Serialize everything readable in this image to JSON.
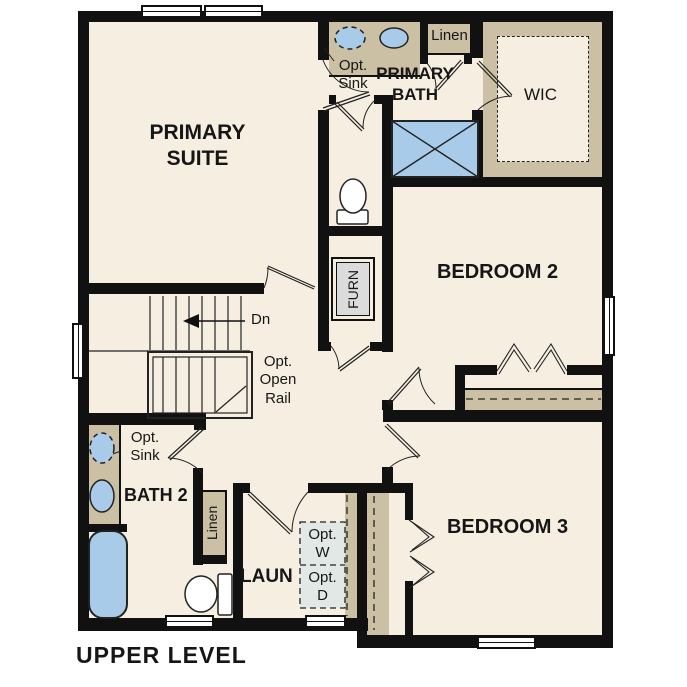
{
  "plan": {
    "title": "UPPER LEVEL",
    "level": "Upper Level floor plan"
  },
  "labels": {
    "primary_suite": "PRIMARY\nSUITE",
    "primary_bath": "PRIMARY\nBATH",
    "wic": "WIC",
    "linen_upper": "Linen",
    "opt_sink_upper": "Opt.\nSink",
    "bedroom2": "BEDROOM 2",
    "bedroom3": "BEDROOM 3",
    "furnace": "FURN",
    "stairs_down": "Dn",
    "opt_open_rail": "Opt.\nOpen\nRail",
    "opt_sink_bath2": "Opt.\nSink",
    "bath2": "BATH 2",
    "linen_lower": "Linen",
    "laundry": "LAUN",
    "opt_washer": "Opt.\nW",
    "opt_dryer": "Opt.\nD"
  },
  "colors": {
    "wall": "#111111",
    "floor": "#f6efe1",
    "casework_tan": "#cbc0a4",
    "fixture_blue": "#a8cbe9",
    "furnace_gray": "#dcdcdc",
    "appliance_gray": "#e2e8e6",
    "line": "#222222"
  },
  "icons": [
    "shower-icon",
    "toilet-icon",
    "sink-icon",
    "tub-icon",
    "door-swing-icon",
    "bifold-door-icon",
    "stairs-icon",
    "window-icon",
    "down-arrow-icon"
  ]
}
